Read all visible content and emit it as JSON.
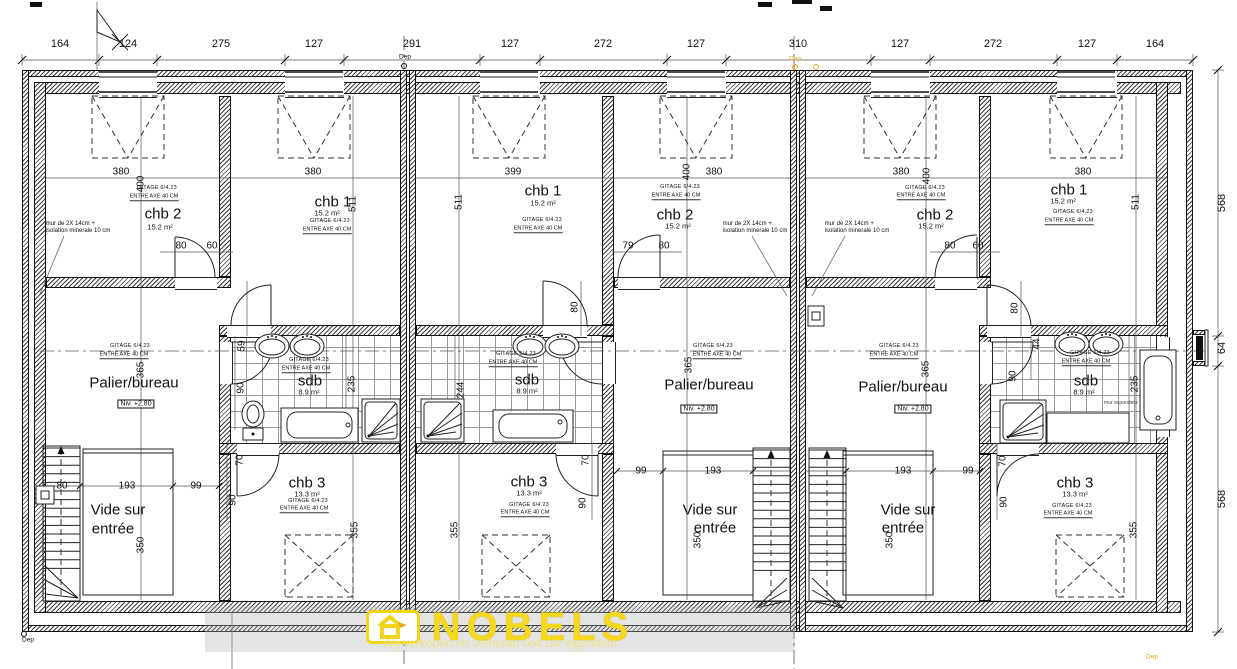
{
  "v": {
    "164": "164",
    "124": "124",
    "275": "275",
    "127": "127",
    "291": "291",
    "272": "272",
    "310": "310",
    "380": "380",
    "399": "399",
    "400": "400",
    "511": "511",
    "568": "568",
    "64": "64",
    "79": "79",
    "80": "80",
    "60": "60",
    "59": "59",
    "44": "44",
    "90": "90",
    "235": "235",
    "244": "244",
    "365": "365",
    "70": "70",
    "193": "193",
    "99": "99",
    "350": "350",
    "355": "355"
  },
  "rooms": {
    "chb1": "chb 1",
    "chb2": "chb 2",
    "chb3": "chb 3",
    "sdb": "sdb",
    "palier": "Palier/bureau",
    "vide1": "Vide sur",
    "vide2": "entrée",
    "a152": "15.2 m²",
    "a133": "13.3 m²",
    "a89": "8.9 m²"
  },
  "ann": {
    "gitage": "GITAGE 6/4.23",
    "entre": "ENTRE AXE 40 CM",
    "mur": "mur de 2X 14cm +\nisolation minerale 10 cm",
    "mursep": "mur separateur",
    "niv": "Niv. +2.80",
    "dep": "Dep"
  },
  "watermark": {
    "brand": "NOBELS",
    "tagline": "Wij verkopen en verhuren ook uw eigendom"
  },
  "colors": {
    "accent": "#f2d41b",
    "hatch": "#3d3d3d",
    "line": "#1c1c1c",
    "dep_orange": "#e8a91f"
  }
}
